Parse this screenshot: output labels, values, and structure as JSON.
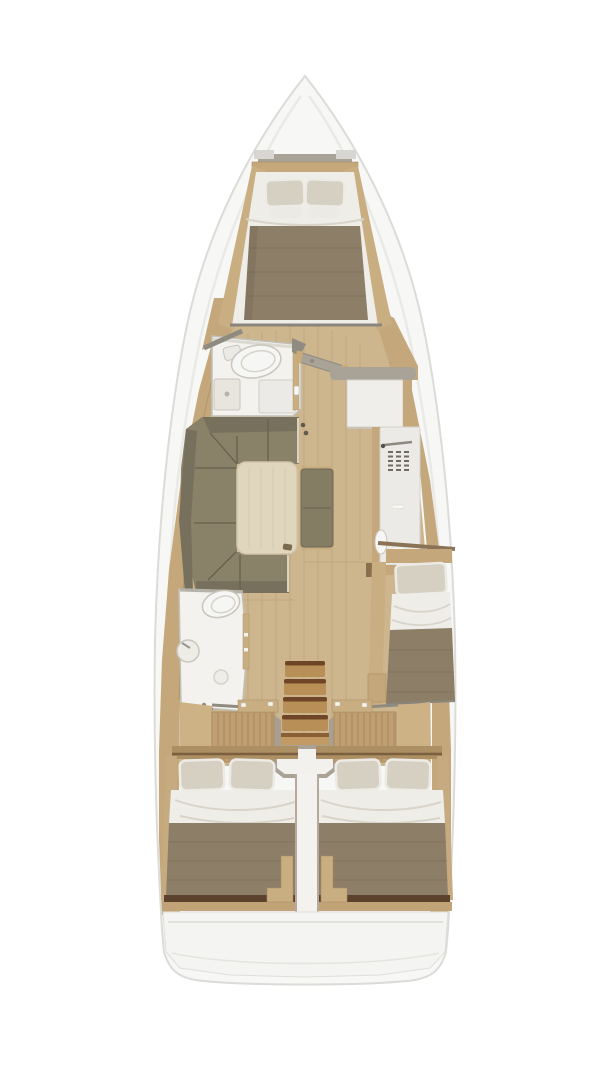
{
  "scene": {
    "type": "yacht-interior-floor-plan",
    "view": "top-down",
    "rooms": [
      "bow-v-berth-cabin",
      "forward-head-bathroom",
      "salon-with-l-sofa-and-table",
      "navigation-cabinet",
      "galley-unit",
      "aft-head-bathroom",
      "companionway-stairs",
      "starboard-single-berth",
      "port-aft-double-cabin",
      "starboard-aft-double-cabin"
    ]
  },
  "colors": {
    "hull": "#f7f7f5",
    "hullStroke": "#dbdbd7",
    "hullInnerLine": "#e9e9e6",
    "deckWood": "#c4a87c",
    "deckSeam": "#9e7f54",
    "floor": "#cdb58e",
    "floorSeam": "#b1946a",
    "room": "#f3f2ee",
    "wall": "#c2bfb6",
    "wallDark": "#8f8b81",
    "fixture": "#f6f6f4",
    "fixtureStroke": "#c9c6bd",
    "cabinet": "#efeeea",
    "cabinetStroke": "#d5d2c9",
    "galley": "#eceae6",
    "vent": "#6f6b62",
    "grayBand": "#a9a296",
    "pillow": "#d6d0c3",
    "pillowEdge": "#edebe5",
    "sheet": "#efede8",
    "sheetFold": "#d8d4ca",
    "blanket": "#8d7e68",
    "blanketShade": "#7e705c",
    "sofa": "#8a8169",
    "sofaDark": "#77705c",
    "sofaLine": "#67604d",
    "sofaHighlight": "#d9d2c0",
    "table": "#e0d5bd",
    "tableEdge": "#cfc3a8",
    "bench": "#857c64",
    "stepWood": "#b98f58",
    "stepEdge": "#6e4526",
    "stepWide": "#c29a63",
    "slats": "#c19f72",
    "slatLine": "#8a6f4b",
    "trimWood": "#c9ae82",
    "trimDark": "#a98c60",
    "darkTrim": "#5c422c",
    "footWood": "#c2a377",
    "headboardWood": "#ac8f63",
    "centerStrip": "#f3f2ef",
    "stripEdge": "#b3aa9d",
    "stern": "#f4f4f2",
    "sternLine": "#e3e1dc",
    "engineStroke": "#aaa295",
    "grayWedge": "#a89f92",
    "doorWood": "#c9ab77",
    "metal": "#8e8a80"
  }
}
